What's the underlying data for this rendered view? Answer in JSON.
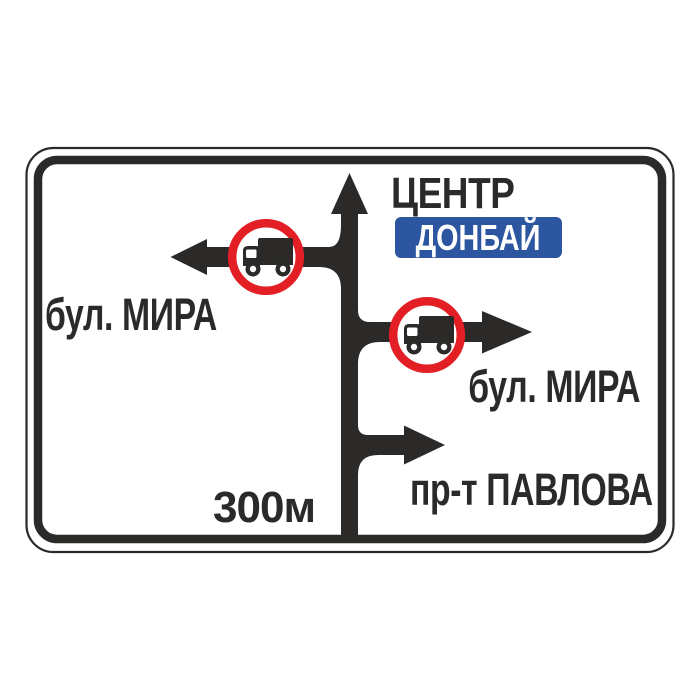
{
  "sign": {
    "kind": "advance direction road sign",
    "straight_ahead": {
      "destination": "ЦЕНТР",
      "route_plate": "ДОНБАЙ"
    },
    "turn_left": {
      "street": "бул. МИРА",
      "restriction": "no trucks"
    },
    "turn_right": {
      "street": "бул. МИРА",
      "restriction": "no trucks"
    },
    "turn_right_far": {
      "street": "пр-т ПАВЛОВА"
    },
    "distance_to_junction": "300м"
  },
  "icons": {
    "main_arrow": "straight-ahead-arrow",
    "left_arrow": "left-turn-arrow",
    "right_arrow": "right-turn-arrow",
    "far_right_arrow": "right-turn-arrow",
    "truck_badge": "no-trucks-prohibition-icon"
  },
  "colors": {
    "sign_black": "#2b2a29",
    "plate_blue": "#2d56a0",
    "prohibition_red": "#e31e24",
    "background_white": "#ffffff"
  }
}
